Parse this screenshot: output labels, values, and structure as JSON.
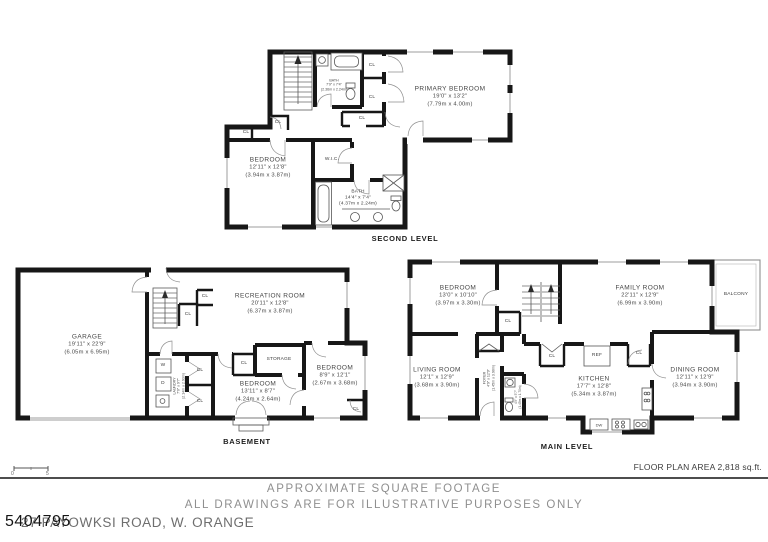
{
  "document": {
    "watermark": "5404795",
    "address": "27 PAYOWKSI ROAD, W. ORANGE",
    "footer": {
      "area": "FLOOR PLAN AREA 2,818 sq.ft.",
      "note1": "APPROXIMATE SQUARE FOOTAGE",
      "note2": "ALL DRAWINGS ARE FOR ILLUSTRATIVE PURPOSES ONLY",
      "scale_start": "0",
      "scale_end": "5"
    }
  },
  "labels": {
    "cl": "CL",
    "ref": "REF",
    "dw": "DW",
    "washer": "W",
    "dryer": "D"
  },
  "levels": {
    "second": {
      "name": "SECOND LEVEL",
      "rooms": {
        "primary_bedroom": {
          "name": "PRIMARY BEDROOM",
          "ft": "19'0\" x 13'2\"",
          "m": "(7.79m x 4.00m)"
        },
        "bedroom": {
          "name": "BEDROOM",
          "ft": "12'11\" x 12'8\"",
          "m": "(3.94m x 3.87m)"
        },
        "bath_upper": {
          "name": "BATH",
          "ft": "7'9\" x 7'4\"",
          "m": "(2.36m x 2.24m)"
        },
        "bath_main": {
          "name": "BATH",
          "ft": "14'4\" x 7'4\"",
          "m": "(4.37m x 2.24m)"
        },
        "wic": {
          "name": "W.I.C."
        }
      }
    },
    "basement": {
      "name": "BASEMENT",
      "rooms": {
        "garage": {
          "name": "GARAGE",
          "ft": "19'11\" x 22'9\"",
          "m": "(6.05m x 6.95m)"
        },
        "recreation": {
          "name": "RECREATION ROOM",
          "ft": "20'11\" x 12'8\"",
          "m": "(6.37m x 3.87m)"
        },
        "storage": {
          "name": "STORAGE"
        },
        "bedroom1": {
          "name": "BEDROOM",
          "ft": "13'11\" x 8'7\"",
          "m": "(4.24m x 2.64m)"
        },
        "bedroom2": {
          "name": "BEDROOM",
          "ft": "8'9\" x 12'1\"",
          "m": "(2.67m x 3.68m)"
        },
        "laundry": {
          "name": "LAUNDRY",
          "ft": "7'0\" x 9'7\"",
          "m": "(2.14m x 2.93m)"
        }
      }
    },
    "main": {
      "name": "MAIN LEVEL",
      "rooms": {
        "bedroom": {
          "name": "BEDROOM",
          "ft": "13'0\" x 10'10\"",
          "m": "(3.97m x 3.30m)"
        },
        "family": {
          "name": "FAMILY ROOM",
          "ft": "22'11\" x 12'9\"",
          "m": "(6.99m x 3.90m)"
        },
        "living": {
          "name": "LIVING ROOM",
          "ft": "12'1\" x 12'9\"",
          "m": "(3.68m x 3.90m)"
        },
        "dining": {
          "name": "DINING ROOM",
          "ft": "12'11\" x 12'9\"",
          "m": "(3.94m x 3.90m)"
        },
        "kitchen": {
          "name": "KITCHEN",
          "ft": "17'7\" x 12'8\"",
          "m": "(5.34m x 3.87m)"
        },
        "foyer": {
          "name": "FOYER",
          "ft": "4'9\" x 12'9\"",
          "m": "(1.45m x 3.90m)"
        },
        "powder": {
          "ft": "4'9\" x 5'7\"",
          "m": "(1.45m x 1.70m)"
        },
        "balcony": {
          "name": "BALCONY"
        }
      }
    }
  }
}
